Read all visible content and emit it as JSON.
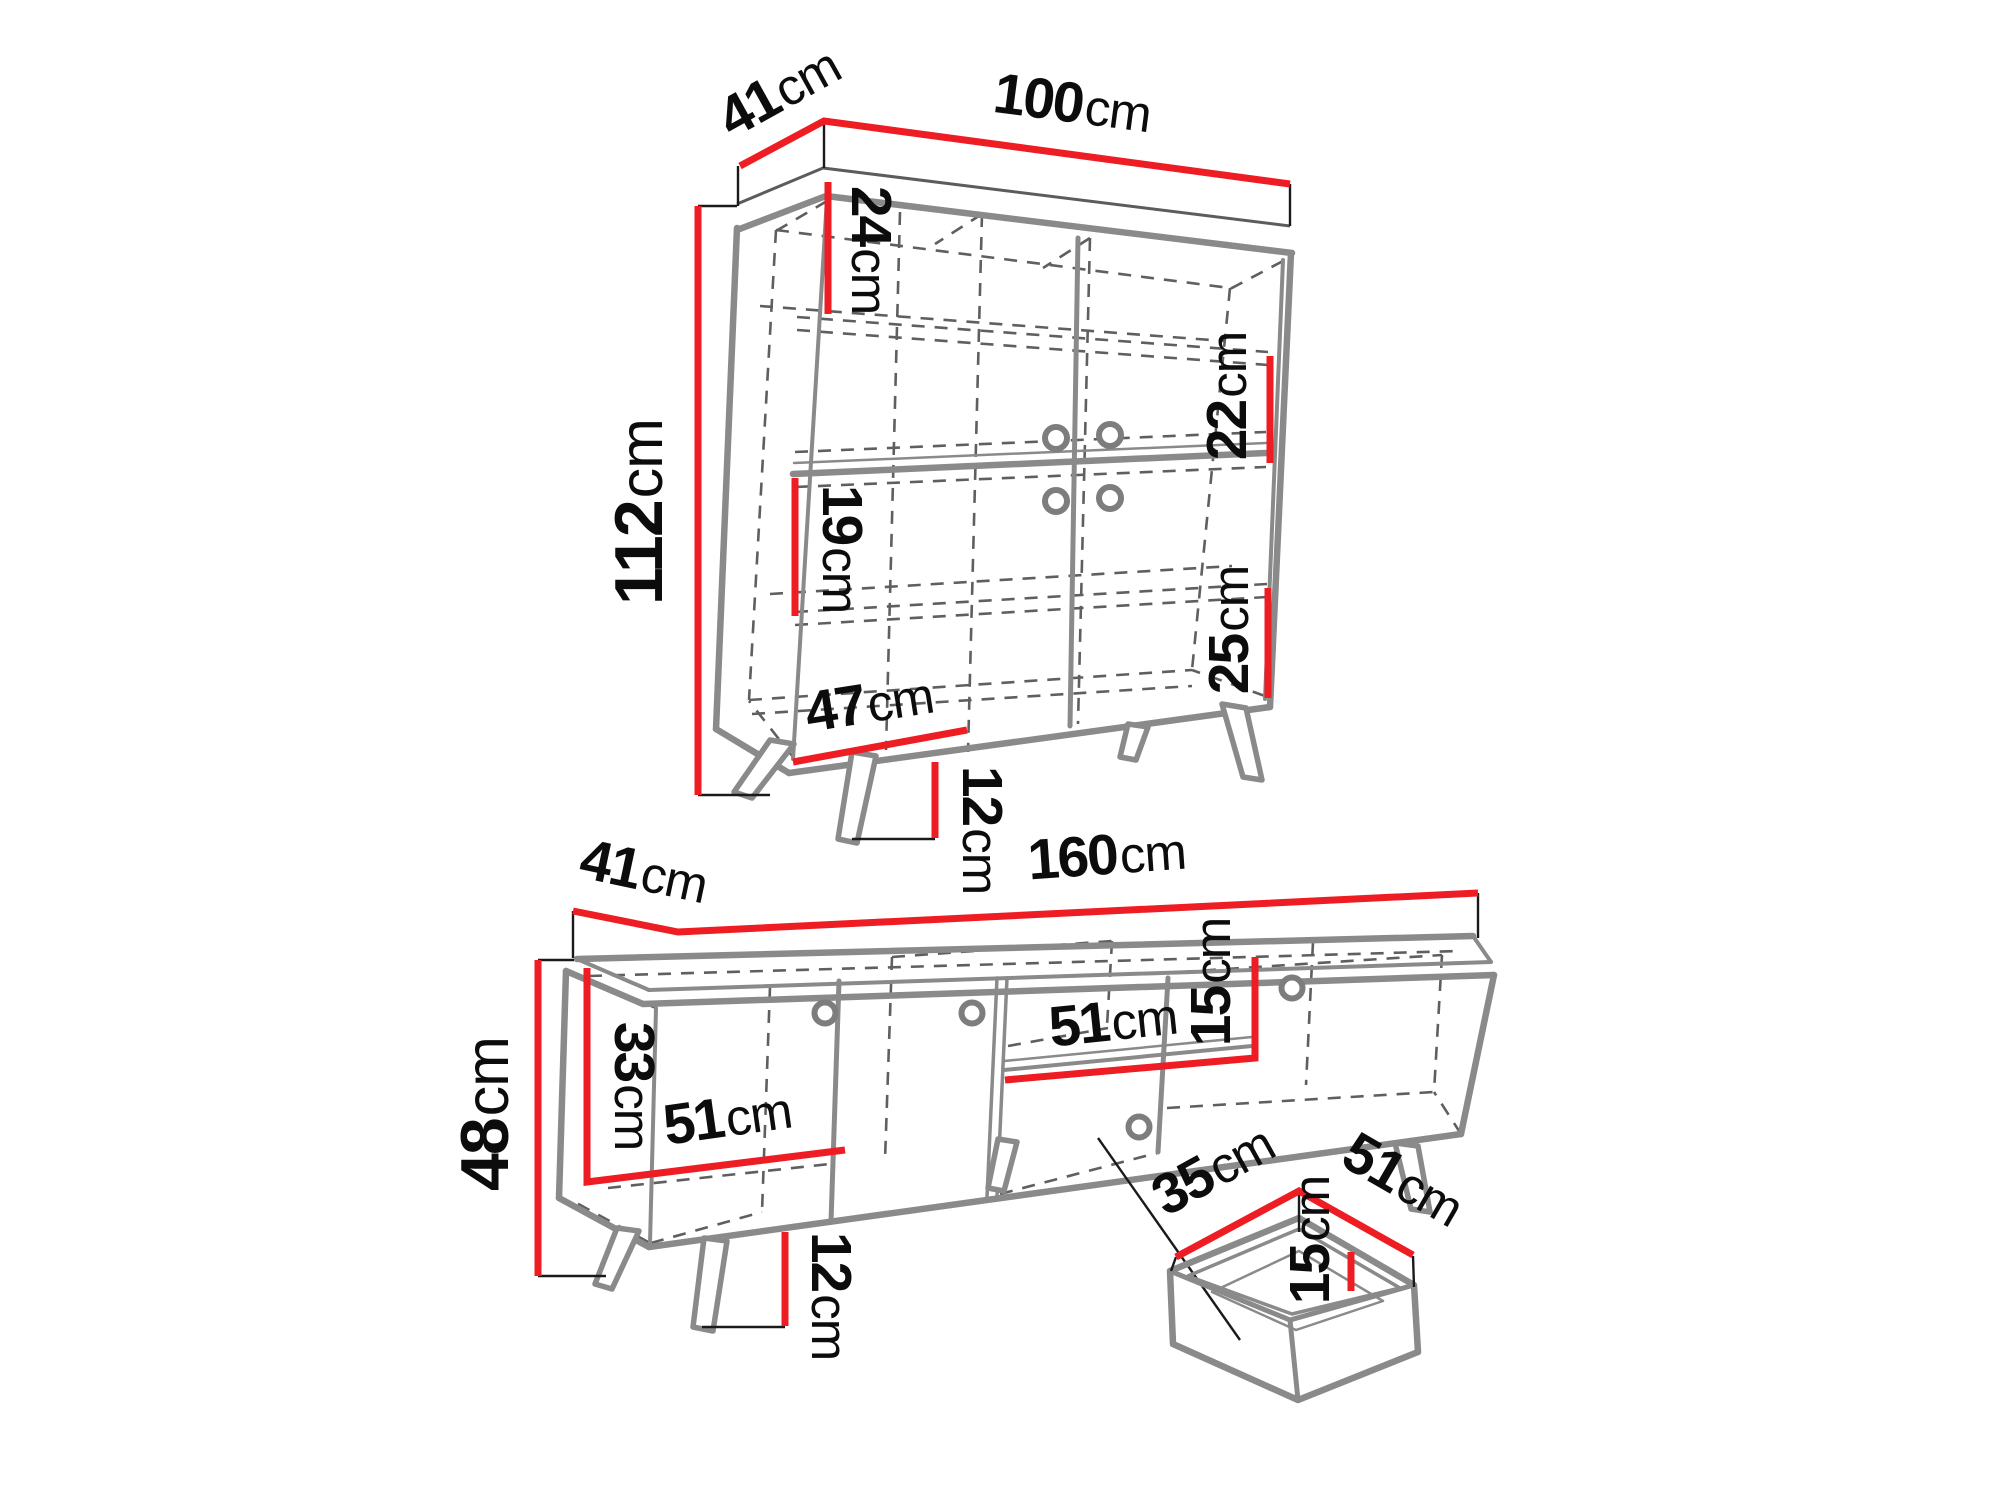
{
  "diagram": {
    "kind": "furniture-dimension-drawing",
    "background": "#ffffff",
    "colors": {
      "dimension_red": "#ee1c23",
      "furniture_gray": "#8a8a8a",
      "hidden_line_gray": "#5f5f5f",
      "text_black": "#0c0c0c"
    }
  },
  "cabinet": {
    "name": "display-cabinet",
    "dims": {
      "depth": {
        "value": "41",
        "unit": "cm"
      },
      "width": {
        "value": "100",
        "unit": "cm"
      },
      "height": {
        "value": "112",
        "unit": "cm"
      },
      "top_section": {
        "value": "24",
        "unit": "cm"
      },
      "upper_right": {
        "value": "22",
        "unit": "cm"
      },
      "middle_left": {
        "value": "19",
        "unit": "cm"
      },
      "lower_right": {
        "value": "25",
        "unit": "cm"
      },
      "inner_width": {
        "value": "47",
        "unit": "cm"
      },
      "leg_height": {
        "value": "12",
        "unit": "cm"
      }
    }
  },
  "tv_stand": {
    "name": "tv-stand",
    "dims": {
      "depth": {
        "value": "41",
        "unit": "cm"
      },
      "width": {
        "value": "160",
        "unit": "cm"
      },
      "height": {
        "value": "48",
        "unit": "cm"
      },
      "inner_height": {
        "value": "33",
        "unit": "cm"
      },
      "left_inner_width": {
        "value": "51",
        "unit": "cm"
      },
      "shelf_width": {
        "value": "51",
        "unit": "cm"
      },
      "shelf_opening": {
        "value": "15",
        "unit": "cm"
      },
      "leg_height": {
        "value": "12",
        "unit": "cm"
      }
    }
  },
  "drawer": {
    "name": "pull-out-drawer",
    "dims": {
      "depth": {
        "value": "35",
        "unit": "cm"
      },
      "width": {
        "value": "51",
        "unit": "cm"
      },
      "inner_height": {
        "value": "15",
        "unit": "cm"
      }
    }
  }
}
